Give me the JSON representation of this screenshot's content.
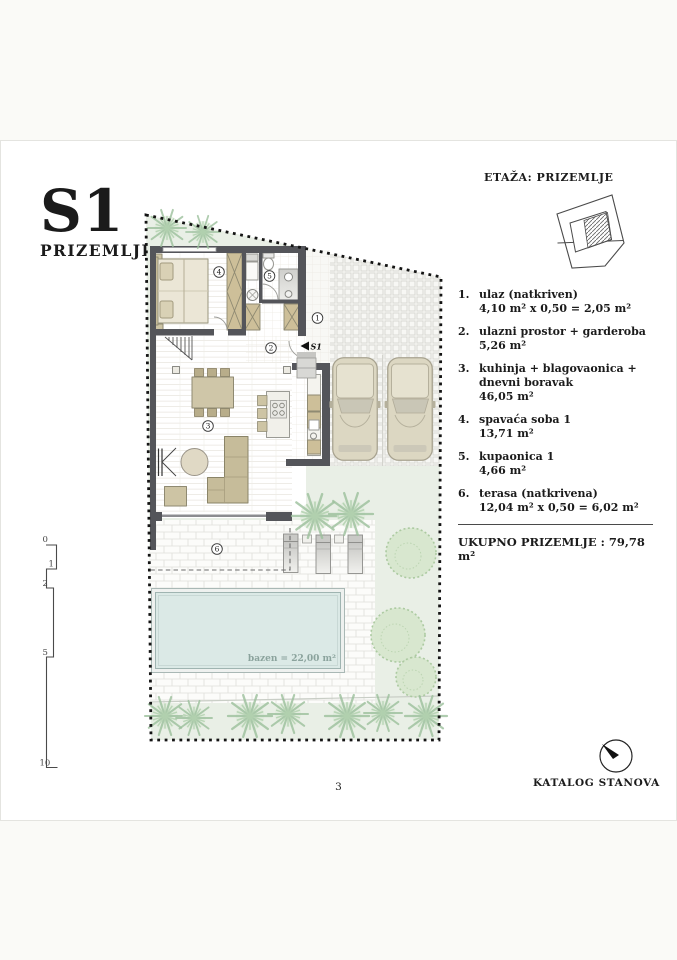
{
  "page": {
    "title": "S1",
    "subtitle": "PRIZEMLJE",
    "etaza_label": "ETAŽA: PRIZEMLJE",
    "page_number": "3",
    "footer_brand": "KATALOG STANOVA"
  },
  "legend": {
    "items": [
      {
        "num": "1.",
        "name": "ulaz (natkriven)",
        "area": "4,10 m² x 0,50 = 2,05 m²"
      },
      {
        "num": "2.",
        "name": "ulazni prostor + garderoba",
        "area": "5,26 m²"
      },
      {
        "num": "3.",
        "name": "kuhinja + blagovaonica +\ndnevni boravak",
        "area": "46,05 m²"
      },
      {
        "num": "4.",
        "name": "spavaća soba 1",
        "area": "13,71 m²"
      },
      {
        "num": "5.",
        "name": "kupaonica 1",
        "area": "4,66 m²"
      },
      {
        "num": "6.",
        "name": "terasa (natkrivena)",
        "area": "12,04 m² x 0,50 = 6,02 m²"
      }
    ],
    "total": "UKUPNO PRIZEMLJE : 79,78 m²"
  },
  "plan": {
    "markers": [
      "1",
      "2",
      "3",
      "4",
      "5",
      "6"
    ],
    "unit_marker": "S1",
    "pool_label": "bazen = 22,00 m²"
  },
  "scale_bar": {
    "labels": [
      "0",
      "1",
      "2",
      "5",
      "10"
    ]
  },
  "colors": {
    "wall": "#54555a",
    "furniture": "#cdc4a4",
    "lawn": "#e9efe6",
    "pool_water": "#dbe9e6",
    "tree_green": "#9cc09c",
    "boundary": "#141414"
  }
}
